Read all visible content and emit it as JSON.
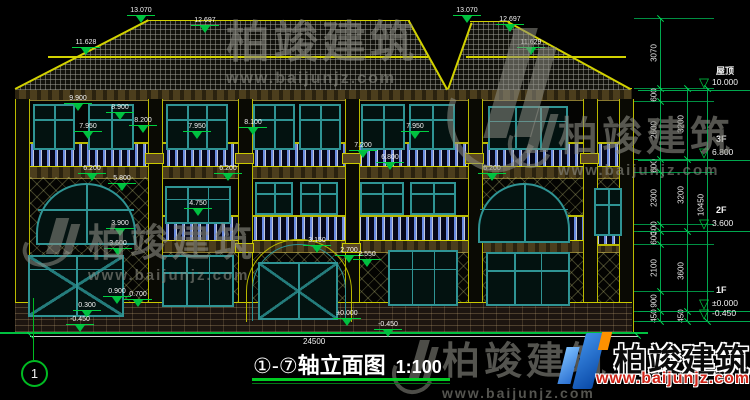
{
  "watermark": {
    "brand": "柏竣建筑",
    "url": "www.baijunjz.com"
  },
  "logo": {
    "brand": "柏竣建筑",
    "url": "www.baijunjz.com"
  },
  "title_block": {
    "axis": "①-⑦",
    "name": "轴立面图",
    "scale": "1:100"
  },
  "axis_bubble": "1",
  "ground_dim": "24500",
  "levels": [
    {
      "label": "屋顶",
      "elev": "10.000",
      "y": 90
    },
    {
      "label": "3F",
      "elev": "6.800",
      "y": 160
    },
    {
      "label": "2F",
      "elev": "3.600",
      "y": 231
    },
    {
      "label": "1F",
      "elev": "±0.000",
      "y": 311
    },
    {
      "label": "",
      "elev": "-0.450",
      "y": 321
    }
  ],
  "right_dims": {
    "columns": [
      {
        "x": 660,
        "ticks": [
          18,
          88,
          101,
          159,
          172,
          224,
          231,
          244,
          291,
          311,
          321
        ],
        "labels": [
          "3070",
          "600",
          "2600",
          "600",
          "2300",
          "300",
          "600",
          "2100",
          "900",
          "450"
        ]
      },
      {
        "x": 687,
        "ticks": [
          88,
          159,
          231,
          311,
          321
        ],
        "labels": [
          "3200",
          "3200",
          "3600",
          "450"
        ]
      },
      {
        "x": 707,
        "ticks": [
          88,
          321
        ],
        "labels": [
          "10450"
        ]
      }
    ]
  },
  "elevation_markers": [
    {
      "v": "13.070",
      "x": 141,
      "y": 7
    },
    {
      "v": "12.697",
      "x": 205,
      "y": 17
    },
    {
      "v": "11.628",
      "x": 86,
      "y": 39
    },
    {
      "v": "13.070",
      "x": 467,
      "y": 7
    },
    {
      "v": "12.697",
      "x": 510,
      "y": 16
    },
    {
      "v": "11.629",
      "x": 531,
      "y": 39
    },
    {
      "v": "9.900",
      "x": 78,
      "y": 95
    },
    {
      "v": "8.900",
      "x": 120,
      "y": 104
    },
    {
      "v": "8.200",
      "x": 143,
      "y": 117
    },
    {
      "v": "7.950",
      "x": 88,
      "y": 123
    },
    {
      "v": "7.950",
      "x": 197,
      "y": 123
    },
    {
      "v": "8.100",
      "x": 253,
      "y": 119
    },
    {
      "v": "7.950",
      "x": 415,
      "y": 123
    },
    {
      "v": "7.200",
      "x": 363,
      "y": 142
    },
    {
      "v": "6.800",
      "x": 390,
      "y": 154
    },
    {
      "v": "6.200",
      "x": 92,
      "y": 165
    },
    {
      "v": "5.800",
      "x": 122,
      "y": 175
    },
    {
      "v": "6.200",
      "x": 228,
      "y": 165
    },
    {
      "v": "6.200",
      "x": 492,
      "y": 165
    },
    {
      "v": "4.750",
      "x": 198,
      "y": 200
    },
    {
      "v": "3.900",
      "x": 120,
      "y": 220
    },
    {
      "v": "3.600",
      "x": 118,
      "y": 240
    },
    {
      "v": "3.150",
      "x": 317,
      "y": 237
    },
    {
      "v": "2.700",
      "x": 349,
      "y": 247
    },
    {
      "v": "2.550",
      "x": 367,
      "y": 251
    },
    {
      "v": "0.900",
      "x": 117,
      "y": 288
    },
    {
      "v": "0.700",
      "x": 138,
      "y": 291
    },
    {
      "v": "0.300",
      "x": 87,
      "y": 302
    },
    {
      "v": "-0.450",
      "x": 80,
      "y": 316
    },
    {
      "v": "±0.000",
      "x": 347,
      "y": 310
    },
    {
      "v": "-0.450",
      "x": 388,
      "y": 321
    }
  ]
}
